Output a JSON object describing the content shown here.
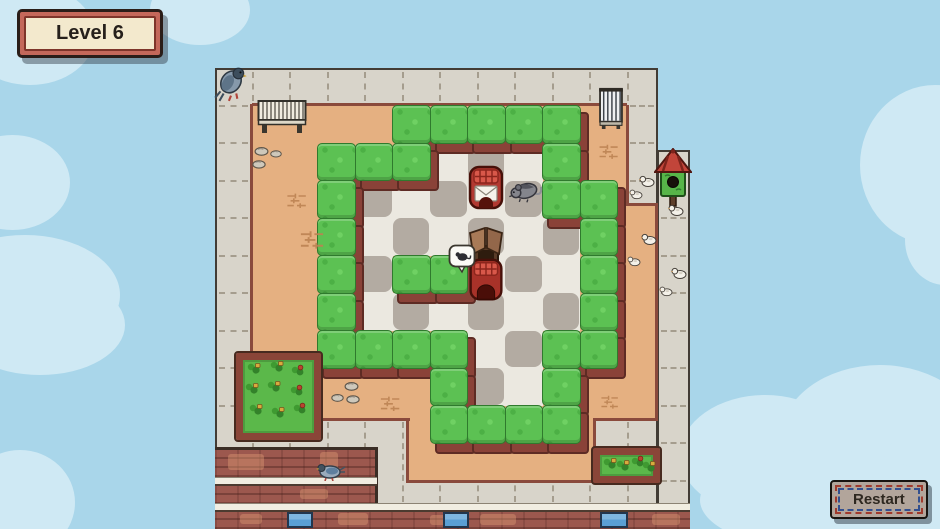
{
  "hud": {
    "level_badge": {
      "label": "Level 6"
    },
    "restart_button": {
      "label": "Restart"
    }
  },
  "palette": {
    "sky": "#a9d6ea",
    "cloud": "#cfe9f4",
    "sidewalk": "#d8d4ca",
    "dash": "#a59d8e",
    "outline": "#423c35",
    "tan": "#e5b081",
    "brown_line": "#8a4a3c",
    "dark_edge": "#3a2d25",
    "hedge": "#5cc153",
    "hedge_dark": "#2f7a2d",
    "hedge_base": "#8a4238",
    "hedge_base_dark": "#5e2b24",
    "floor_light": "#ebe8e0",
    "floor_dark": "#b3aba2",
    "brick": "#9c584e",
    "ledge": "#f1ede1",
    "window_blue": "#5b9fd4"
  },
  "sky": {
    "clouds": [
      [
        -35,
        -15,
        130,
        100
      ],
      [
        150,
        -25,
        100,
        70
      ],
      [
        -45,
        135,
        115,
        95
      ],
      [
        -70,
        235,
        190,
        120
      ],
      [
        -45,
        275,
        170,
        100
      ],
      [
        -35,
        450,
        110,
        105
      ],
      [
        860,
        85,
        150,
        160
      ],
      [
        905,
        195,
        80,
        90
      ],
      [
        680,
        395,
        170,
        120
      ],
      [
        780,
        365,
        200,
        150
      ],
      [
        880,
        425,
        90,
        110
      ],
      [
        700,
        450,
        240,
        100
      ]
    ]
  },
  "board": {
    "base": {
      "x": 215,
      "y": 68,
      "w": 443,
      "h": 461
    },
    "extension": {
      "x": 657,
      "y": 150,
      "w": 33,
      "h": 363
    },
    "dash_regions": [
      {
        "x": 215,
        "y": 70,
        "w": 443,
        "h": 33,
        "dir": "v"
      },
      {
        "x": 217,
        "y": 68,
        "w": 33,
        "h": 352,
        "dir": "h"
      },
      {
        "x": 628,
        "y": 68,
        "w": 28,
        "h": 137,
        "dir": "h"
      },
      {
        "x": 659,
        "y": 150,
        "w": 29,
        "h": 353,
        "dir": "h"
      },
      {
        "x": 215,
        "y": 420,
        "w": 475,
        "h": 84,
        "dir": "v"
      }
    ],
    "courtyard": [
      {
        "x": 252,
        "y": 105,
        "w": 375,
        "h": 100
      },
      {
        "x": 252,
        "y": 205,
        "w": 405,
        "h": 215
      },
      {
        "x": 408,
        "y": 420,
        "w": 187,
        "h": 61
      }
    ],
    "lines": [
      [
        252,
        103,
        375,
        3
      ],
      [
        250,
        104,
        3,
        318
      ],
      [
        626,
        105,
        3,
        101
      ],
      [
        627,
        203,
        31,
        3
      ],
      [
        655,
        205,
        3,
        216
      ],
      [
        252,
        418,
        158,
        3
      ],
      [
        406,
        420,
        3,
        63
      ],
      [
        408,
        480,
        187,
        3
      ],
      [
        593,
        420,
        3,
        62
      ],
      [
        593,
        418,
        64,
        3
      ]
    ],
    "buildings": {
      "bricks": [
        {
          "x": 215,
          "y": 450,
          "w": 162,
          "h": 63,
          "name": "rooftop-building-left"
        },
        {
          "x": 215,
          "y": 512,
          "w": 475,
          "h": 17,
          "name": "street-facade"
        }
      ],
      "ledges": [
        {
          "x": 215,
          "y": 477,
          "w": 162,
          "h": 9
        },
        {
          "x": 215,
          "y": 503,
          "w": 475,
          "h": 9
        }
      ],
      "edges": [
        [
          375,
          450,
          3,
          62
        ],
        [
          215,
          447,
          163,
          3
        ]
      ],
      "patches": [
        [
          228,
          454,
          36,
          16
        ],
        [
          300,
          489,
          28,
          10
        ],
        [
          338,
          513,
          30,
          12
        ],
        [
          480,
          514,
          36,
          11
        ],
        [
          652,
          514,
          28,
          11
        ],
        [
          240,
          514,
          22,
          10
        ],
        [
          320,
          452,
          18,
          22
        ],
        [
          430,
          515,
          20,
          10
        ]
      ],
      "windows": [
        [
          287,
          512,
          26,
          16
        ],
        [
          443,
          512,
          26,
          16
        ],
        [
          600,
          512,
          28,
          16
        ]
      ]
    }
  },
  "maze": {
    "origin_x": 317,
    "origin_y": 105,
    "tile": 37.5,
    "map": [
      "  HHHHH  ",
      "HHH...H  ",
      "H.....HH ",
      "H......H ",
      "H.HH...H ",
      "H......H ",
      "HHHH..HH ",
      "   H..H  ",
      "   HHHH  "
    ]
  },
  "objects": [
    {
      "type": "bench-h",
      "name": "bench-horizontal",
      "x": 257,
      "y": 99,
      "w": 50,
      "h": 36,
      "inter": false
    },
    {
      "type": "bench-v",
      "name": "bench-vertical",
      "x": 597,
      "y": 87,
      "w": 28,
      "h": 42,
      "inter": false
    },
    {
      "type": "pigeon",
      "name": "pigeon",
      "x": 214,
      "y": 64,
      "w": 34,
      "h": 40,
      "inter": false
    },
    {
      "type": "pigeon2",
      "name": "pigeon-on-ledge",
      "x": 316,
      "y": 461,
      "w": 30,
      "h": 20,
      "inter": false
    },
    {
      "type": "birdhouse",
      "name": "birdhouse",
      "x": 654,
      "y": 148,
      "w": 38,
      "h": 60,
      "inter": false
    },
    {
      "type": "dove",
      "name": "dove",
      "x": 639,
      "y": 174,
      "w": 16,
      "h": 14,
      "inter": false
    },
    {
      "type": "dove",
      "name": "dove",
      "x": 629,
      "y": 187,
      "w": 14,
      "h": 12,
      "inter": false
    },
    {
      "type": "dove",
      "name": "dove",
      "x": 668,
      "y": 203,
      "w": 16,
      "h": 14,
      "inter": false
    },
    {
      "type": "dove",
      "name": "dove",
      "x": 641,
      "y": 232,
      "w": 16,
      "h": 14,
      "inter": false
    },
    {
      "type": "dove",
      "name": "dove",
      "x": 627,
      "y": 254,
      "w": 14,
      "h": 12,
      "inter": false
    },
    {
      "type": "dove",
      "name": "dove",
      "x": 671,
      "y": 266,
      "w": 16,
      "h": 14,
      "inter": false
    },
    {
      "type": "dove",
      "name": "dove",
      "x": 659,
      "y": 284,
      "w": 14,
      "h": 12,
      "inter": false
    },
    {
      "type": "rock",
      "name": "rock",
      "x": 254,
      "y": 143,
      "w": 15,
      "h": 10,
      "inter": false
    },
    {
      "type": "rock",
      "name": "rock",
      "x": 270,
      "y": 146,
      "w": 12,
      "h": 11,
      "inter": false
    },
    {
      "type": "rock",
      "name": "rock",
      "x": 252,
      "y": 156,
      "w": 14,
      "h": 10,
      "inter": false
    },
    {
      "type": "rock",
      "name": "rock",
      "x": 344,
      "y": 378,
      "w": 15,
      "h": 10,
      "inter": false
    },
    {
      "type": "rock",
      "name": "rock",
      "x": 331,
      "y": 389,
      "w": 13,
      "h": 9,
      "inter": false
    },
    {
      "type": "rock",
      "name": "rock",
      "x": 346,
      "y": 391,
      "w": 14,
      "h": 10,
      "inter": false
    },
    {
      "type": "decal",
      "name": "brick-marks",
      "x": 283,
      "y": 192,
      "w": 28,
      "h": 16,
      "inter": false
    },
    {
      "type": "decal",
      "name": "brick-marks",
      "x": 598,
      "y": 141,
      "w": 22,
      "h": 20,
      "inter": false
    },
    {
      "type": "decal",
      "name": "brick-marks",
      "x": 299,
      "y": 229,
      "w": 27,
      "h": 20,
      "inter": false
    },
    {
      "type": "decal",
      "name": "brick-marks",
      "x": 377,
      "y": 395,
      "w": 27,
      "h": 16,
      "inter": false
    },
    {
      "type": "decal",
      "name": "brick-marks",
      "x": 600,
      "y": 391,
      "w": 20,
      "h": 21,
      "inter": false
    },
    {
      "type": "garden",
      "name": "garden-plot",
      "x": 236,
      "y": 353,
      "w": 85,
      "h": 87,
      "inter": false,
      "plants": [
        [
          3,
          2
        ],
        [
          26,
          0
        ],
        [
          47,
          4
        ],
        [
          1,
          22
        ],
        [
          23,
          20
        ],
        [
          46,
          24
        ],
        [
          5,
          43
        ],
        [
          27,
          46
        ],
        [
          49,
          42
        ]
      ]
    },
    {
      "type": "garden",
      "name": "garden-box-small",
      "x": 593,
      "y": 448,
      "w": 67,
      "h": 35,
      "inter": false,
      "plants": [
        [
          2,
          2
        ],
        [
          15,
          4
        ],
        [
          30,
          0
        ],
        [
          41,
          5
        ]
      ]
    },
    {
      "type": "mailbox",
      "name": "mailbox-envelope",
      "x": 467,
      "y": 164,
      "w": 38,
      "h": 50,
      "inter": true,
      "envelope": true
    },
    {
      "type": "rat",
      "name": "rat-character",
      "x": 507,
      "y": 173,
      "w": 36,
      "h": 35,
      "inter": true
    },
    {
      "type": "crate",
      "name": "open-crate",
      "x": 465,
      "y": 227,
      "w": 42,
      "h": 44,
      "inter": true
    },
    {
      "type": "mailbox",
      "name": "mailbox-open",
      "x": 467,
      "y": 257,
      "w": 38,
      "h": 48,
      "inter": true,
      "envelope": false
    },
    {
      "type": "bubble",
      "name": "mouse-thought-bubble",
      "x": 448,
      "y": 244,
      "w": 28,
      "h": 30,
      "inter": false
    }
  ]
}
